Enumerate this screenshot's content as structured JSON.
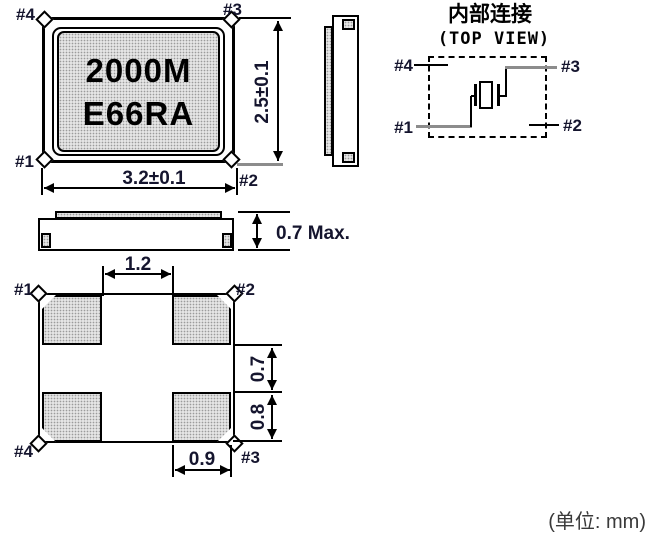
{
  "top_view": {
    "marking_line1": "2000M",
    "marking_line2": "E66RA",
    "pin_top_left": "#4",
    "pin_top_right": "#3",
    "pin_bottom_left": "#1",
    "pin_bottom_right": "#2",
    "dim_width": "3.2±0.1",
    "dim_height": "2.5±0.1"
  },
  "side_view": {
    "dim_thickness": "0.7 Max."
  },
  "internal_connection": {
    "title": "内部连接",
    "subtitle": "(TOP VIEW)",
    "pin_top_left": "#4",
    "pin_top_right": "#3",
    "pin_bottom_left": "#1",
    "pin_bottom_right": "#2"
  },
  "bottom_view": {
    "pin_top_left": "#1",
    "pin_top_right": "#2",
    "pin_bottom_left": "#4",
    "pin_bottom_right": "#3",
    "dim_pad_gap_horizontal": "1.2",
    "dim_pad_gap_vertical": "0.7",
    "dim_pad_height": "0.8",
    "dim_pad_width": "0.9"
  },
  "footer": {
    "unit_note": "(单位: mm)"
  },
  "colors": {
    "line": "#000000",
    "stipple_fill": "#e4e4e4",
    "gray_line": "#8c8c8c",
    "label_text": "#15152e"
  }
}
